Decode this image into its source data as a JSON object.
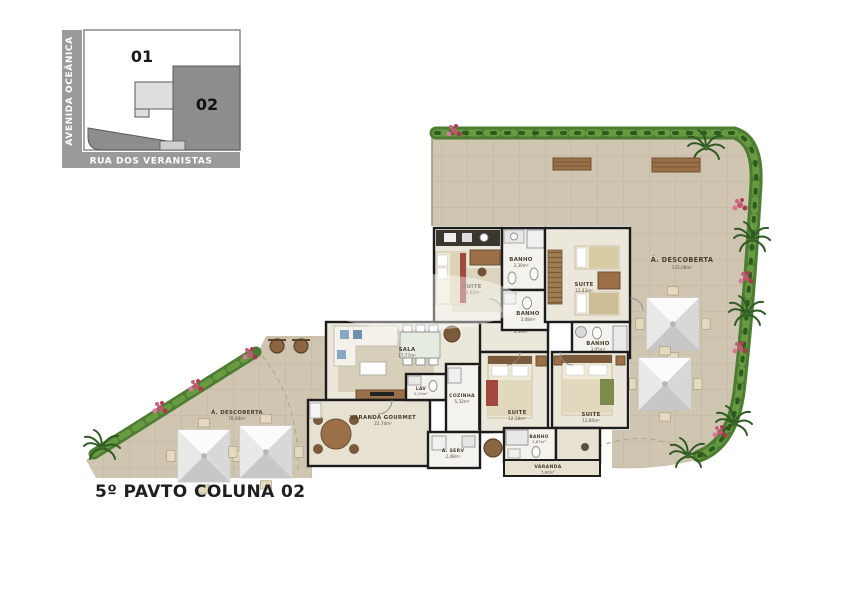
{
  "title": "5º PAVTO COLUNA 02",
  "key_map": {
    "street_left": "AVENIDA  OCEÂNICA",
    "street_bottom": "RUA DOS VERANISTAS",
    "unit_01": "01",
    "unit_02": "02"
  },
  "open_areas": {
    "desc_right": {
      "name": "Á. DESCOBERTA",
      "area": "135,08m²"
    },
    "desc_left": {
      "name": "Á. DESCOBERTA",
      "area": "78,08m²"
    }
  },
  "rooms": {
    "suite_tl": {
      "name": "SUITE",
      "area": "12,65m²"
    },
    "banho_1": {
      "name": "BANHO",
      "area": "3,30m²"
    },
    "banho_2": {
      "name": "BANHO",
      "area": "3,08m²"
    },
    "suite_tr": {
      "name": "SUITE",
      "area": "12,43m²"
    },
    "banho_3": {
      "name": "BANHO",
      "area": "3,05m²"
    },
    "circ": {
      "name": "CIRC",
      "area": "3,50m²"
    },
    "sala": {
      "name": "SALA",
      "area": "17,77m²"
    },
    "lav": {
      "name": "LAV",
      "area": "2,15m²"
    },
    "cozinha": {
      "name": "COZINHA",
      "area": "5,32m²"
    },
    "a_serv": {
      "name": "Á. SERV",
      "area": "2,48m²"
    },
    "varanda_gourmet": {
      "name": "VARANDA GOURMET",
      "area": "22,74m²"
    },
    "suite_bl": {
      "name": "SUITE",
      "area": "12,18m²"
    },
    "suite_br": {
      "name": "SUITE",
      "area": "12,80m²"
    },
    "banho_4": {
      "name": "BANHO",
      "area": "2,67m²"
    },
    "varanda": {
      "name": "VARANDA",
      "area": "5,86m²"
    }
  },
  "colors": {
    "terrace_floor": "#cfc5b1",
    "room_floor": "#ece7db",
    "wall": "#1c1c1c",
    "hedge_green": "#4d7d33",
    "flower_pink": "#c2566e",
    "map_unit02_gray": "#8d8d8d",
    "wood_brown": "#9b7049"
  }
}
